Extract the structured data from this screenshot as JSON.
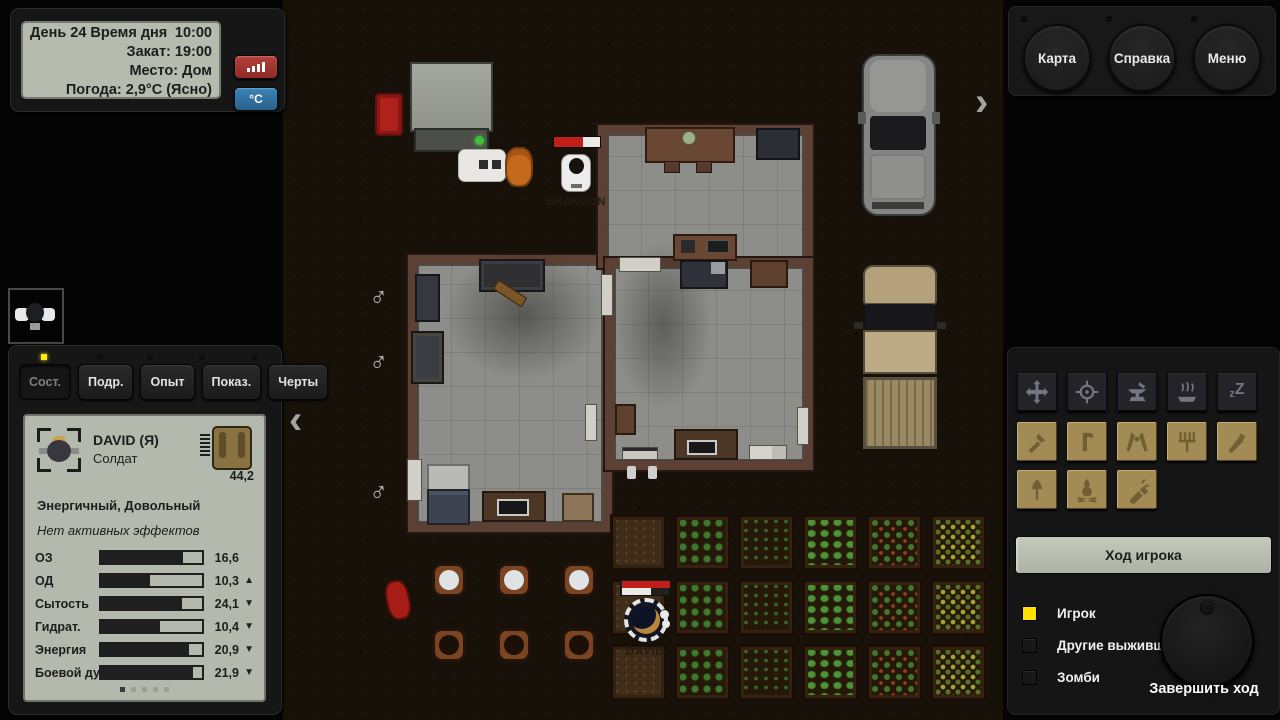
{
  "info_panel": {
    "day_label": "День 24 Время дня",
    "time": "10:00",
    "sunset": "Закат: 19:00",
    "place": "Место: Дом",
    "weather": "Погода: 2,9°C (Ясно)",
    "signal_button_icon": "signal-bars-icon",
    "temp_button_label": "°C"
  },
  "menu_buttons": [
    {
      "label": "Карта"
    },
    {
      "label": "Справка"
    },
    {
      "label": "Меню"
    }
  ],
  "character_panel": {
    "tabs": [
      {
        "label": "Сост.",
        "active": true
      },
      {
        "label": "Подр.",
        "active": false
      },
      {
        "label": "Опыт",
        "active": false
      },
      {
        "label": "Показ.",
        "active": false
      },
      {
        "label": "Черты",
        "active": false
      }
    ],
    "name": "DAVID (Я)",
    "role": "Солдат",
    "weight": "44,2",
    "mood": "Энергичный, Довольный",
    "effects": "Нет активных эффектов",
    "stats": [
      {
        "label": "ОЗ",
        "value": "16,6",
        "pct": 81,
        "arrow": ""
      },
      {
        "label": "ОД",
        "value": "10,3",
        "pct": 49,
        "arrow": "▲"
      },
      {
        "label": "Сытость",
        "value": "24,1",
        "pct": 80,
        "arrow": "▼"
      },
      {
        "label": "Гидрат.",
        "value": "10,4",
        "pct": 58,
        "arrow": "▼"
      },
      {
        "label": "Энергия",
        "value": "20,9",
        "pct": 87,
        "arrow": "▼"
      },
      {
        "label": "Боевой дух",
        "value": "21,9",
        "pct": 91,
        "arrow": "▼"
      }
    ],
    "page_count": 5,
    "active_page": 1
  },
  "map": {
    "nav_left": "‹",
    "nav_right": "›",
    "male_symbol": "♂",
    "survivors": [
      {
        "name": "BRANDON",
        "hp_red_pct": 62,
        "hp_white_pct": 38
      },
      {
        "name": "DAVID",
        "hp_top_red_pct": 100,
        "hp_white_pct": 60
      }
    ],
    "crop_grid": [
      [
        "dirt",
        "bush",
        "sprout",
        "leafy",
        "berry",
        "corn"
      ],
      [
        "dirt",
        "bush",
        "sprout",
        "leafy",
        "berry",
        "corn"
      ],
      [
        "dirt",
        "bush",
        "sprout",
        "leafy",
        "berry",
        "corn"
      ]
    ]
  },
  "action_panel": {
    "dark_tools": [
      "move",
      "target",
      "forge",
      "cook",
      "sleep"
    ],
    "tan_tools_row1": [
      "axe",
      "crowbar",
      "pliers",
      "pitchfork",
      "knife"
    ],
    "tan_tools_row2": [
      "shovel",
      "campfire",
      "flashlight"
    ],
    "sleep_small": "z",
    "sleep_big": "Z",
    "turn_bar": "Ход игрока",
    "legend": [
      {
        "label": "Игрок",
        "color": "#ffe000"
      },
      {
        "label": "Другие выжившие",
        "color": "#181818"
      },
      {
        "label": "Зомби",
        "color": "#181818"
      }
    ],
    "end_turn": "Завершить ход"
  },
  "colors": {
    "accent_yellow": "#ffe000",
    "lcd_screen": "#b5bbae",
    "health_red": "#c21f1a",
    "signal_button": "#a8342e",
    "temp_button": "#2f74a8",
    "tan_button": "#a28b54",
    "wall_brown": "#5d4034",
    "floor_gray": "#8d8d89"
  }
}
